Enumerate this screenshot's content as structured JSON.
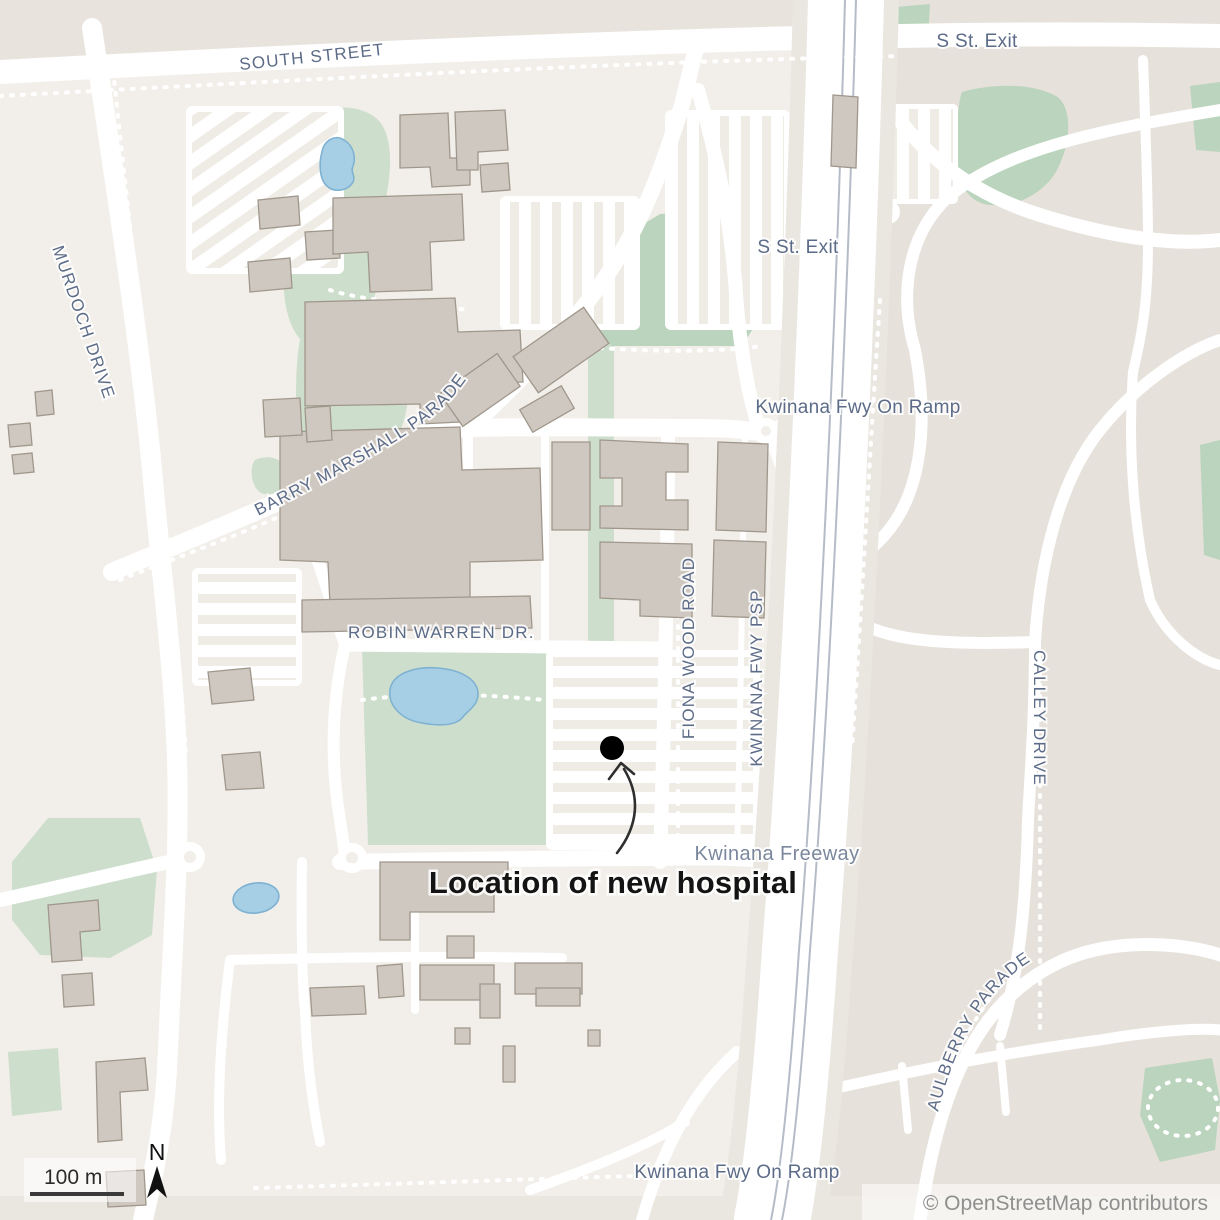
{
  "labels": {
    "south_street": "SOUTH STREET",
    "s_st_exit_top": "S St. Exit",
    "s_st_exit_mid": "S St. Exit",
    "kwinana_fwy_on_ramp_mid": "Kwinana Fwy On Ramp",
    "murdoch_drive": "MURDOCH DRIVE",
    "barry_marshall_parade": "BARRY MARSHALL PARADE",
    "robin_warren_dr": "ROBIN WARREN DR.",
    "fiona_wood_road": "FIONA WOOD ROAD",
    "kwinana_fwy_psp": "KWINANA FWY PSP",
    "kwinana_freeway": "Kwinana Freeway",
    "calley_drive": "CALLEY DRIVE",
    "aulberry_parade": "AULBERRY PARADE",
    "kwinana_fwy_on_ramp_bottom": "Kwinana Fwy On Ramp"
  },
  "annotation": {
    "text": "Location of new hospital"
  },
  "scale_bar": {
    "label": "100 m"
  },
  "compass": {
    "label": "N"
  },
  "attribution": "© OpenStreetMap contributors",
  "colors": {
    "background_light": "#f2efea",
    "background_dark": "#e6e1da",
    "road": "#ffffff",
    "building": "#cfc8c0",
    "building_edge": "#a0978c",
    "park_green": "#cddfcc",
    "field_green": "#bad4bd",
    "water": "#a6cfe5",
    "railway": "#b6bcc7",
    "street_label": "#5c6b87",
    "annotation_text": "#141414",
    "marker": "#000000"
  }
}
